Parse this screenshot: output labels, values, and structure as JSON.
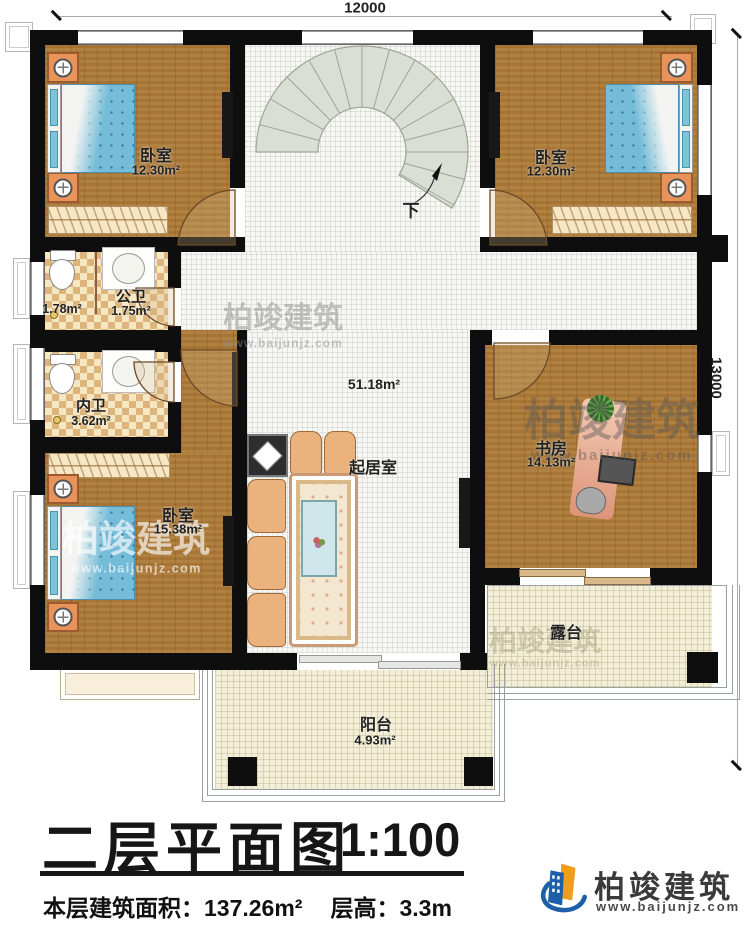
{
  "dimensions": {
    "top": "12000",
    "right": "13000"
  },
  "stairs": {
    "down": "下"
  },
  "rooms": {
    "bedroom_tl": {
      "name": "卧室",
      "area": "12.30m²"
    },
    "bedroom_tr": {
      "name": "卧室",
      "area": "12.30m²"
    },
    "public_bath": {
      "name": "公卫",
      "area": "1.75m²",
      "anteroom_area": "1.78m²"
    },
    "ensuite_bath": {
      "name": "内卫",
      "area": "3.62m²"
    },
    "bedroom_bl": {
      "name": "卧室",
      "area": "15.38m²"
    },
    "living": {
      "name": "起居室",
      "area": "51.18m²"
    },
    "study": {
      "name": "书房",
      "area": "14.13m²"
    },
    "terrace": {
      "name": "露台"
    },
    "balcony": {
      "name": "阳台",
      "area": "4.93m²"
    }
  },
  "title_block": {
    "title": "二层平面图",
    "scale": "1:100",
    "area_label": "本层建筑面积：",
    "area_value": "137.26m²",
    "height_label": "层高：",
    "height_value": "3.3m"
  },
  "brand": {
    "name": "柏竣建筑",
    "url": "www.baijunjz.com"
  },
  "watermark": {
    "name": "柏竣建筑",
    "url": "www.baijunjz.com"
  },
  "colors": {
    "wall": "#0e0e0e",
    "wood_floor": "#ad7a38",
    "tile_floor": "#f7f7f4",
    "bath_tile": "#ddb57c",
    "bed": "#74bcd8",
    "stair": "#dadfd6",
    "outdoor_floor": "#f2eed7",
    "furniture_orange": "#e8935a",
    "logo_blue": "#1d5fa8",
    "logo_orange": "#f09c1c"
  }
}
